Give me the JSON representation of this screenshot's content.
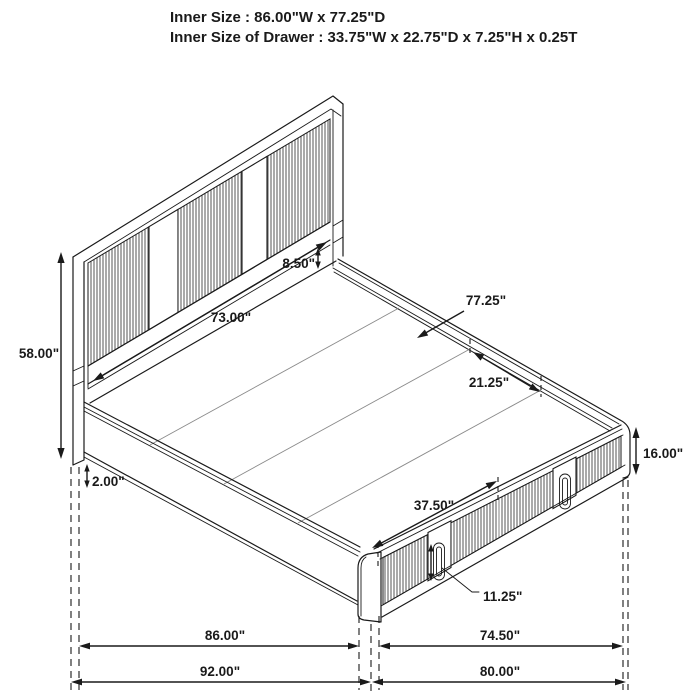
{
  "header": {
    "line1": "Inner Size : 86.00\"W x 77.25\"D",
    "line2": "Inner Size of Drawer : 33.75\"W x 22.75\"D x 7.25\"H x 0.25T"
  },
  "dimensions": {
    "headboard_height": "58.00\"",
    "headboard_panel_width": "73.00\"",
    "headboard_rail_height": "8.50\"",
    "deck_depth": "77.25\"",
    "deck_board_width": "21.25\"",
    "floor_clearance": "2.00\"",
    "drawer_span": "37.50\"",
    "platform_height": "16.00\"",
    "drawer_handle_height": "11.25\"",
    "inner_width": "86.00\"",
    "overall_width": "92.00\"",
    "footboard_inner_width": "74.50\"",
    "overall_depth": "80.00\""
  },
  "colors": {
    "line": "#1a1a1a",
    "background": "#ffffff",
    "rib": "#565656"
  }
}
